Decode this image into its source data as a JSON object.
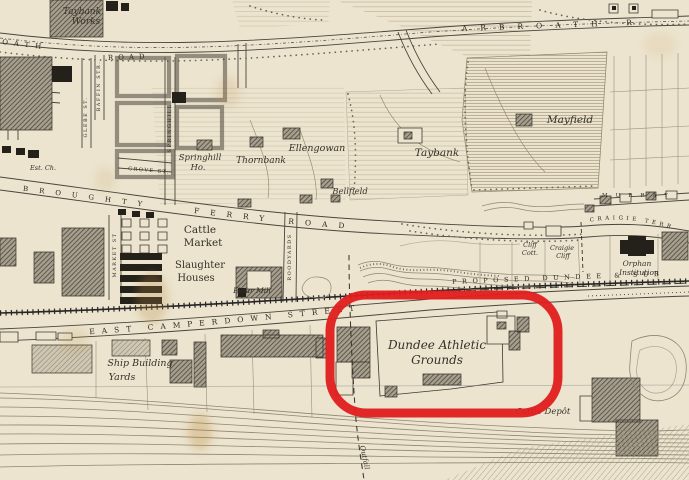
{
  "palette": {
    "paper": "#ece4cf",
    "ink": "#35312a",
    "building_dark": "#46423a",
    "building_black": "#24211b"
  },
  "annotation": {
    "color": "#e11d1d",
    "highlighted_label": "Dundee Athletic Grounds"
  },
  "labels": {
    "streets": {
      "arbroath_left_a": "OATH",
      "arbroath_left_b": "ROAD",
      "arbroath_right": "ARBROATH R",
      "broughty": "BROUGHTY",
      "ferry_road": "FERRY  ROAD",
      "grove_st": "GROVE ST.",
      "glebe_st": "GLEBE ST.",
      "baffin_str": "BAFFIN STR.",
      "springhill_st": "SPRINGHILL",
      "market_st": "MARKET ST",
      "roodyards": "ROODYARDS",
      "east_camperdown": "EAST CAMPERDOWN STREET",
      "craigie_terrace": "CRAIGIE TERR",
      "murray": "MURRAY",
      "proposed_railway": "PROPOSED DUNDEE & SUB",
      "outfall": "Outfall"
    },
    "places": {
      "taybank_works": [
        "Taybank",
        "Works"
      ],
      "est_ch": "Est. Ch.",
      "springhill_ho": [
        "Springhill",
        "Ho."
      ],
      "thornbank": "Thornbank",
      "ellengowan": "Ellengowan",
      "bellfield": "Bellfield",
      "taybank": "Taybank",
      "mayfield": "Mayfield",
      "cattle_market": [
        "Cattle",
        "Market"
      ],
      "slaughter_houses": [
        "Slaughter",
        "Houses"
      ],
      "flour_mill": "Flour Mill",
      "cliff_cott": [
        "Cliff",
        "Cott."
      ],
      "craigie_cliff": [
        "Craigie",
        "Cliff"
      ],
      "orphan_institution": [
        "Orphan",
        "Institution"
      ],
      "ship_building_yards": [
        "Ship Building",
        "Yards"
      ],
      "dundee_athletic_grounds": [
        "Dundee Athletic",
        "Grounds"
      ],
      "cattle_depot": "Cattle Depôt"
    }
  }
}
